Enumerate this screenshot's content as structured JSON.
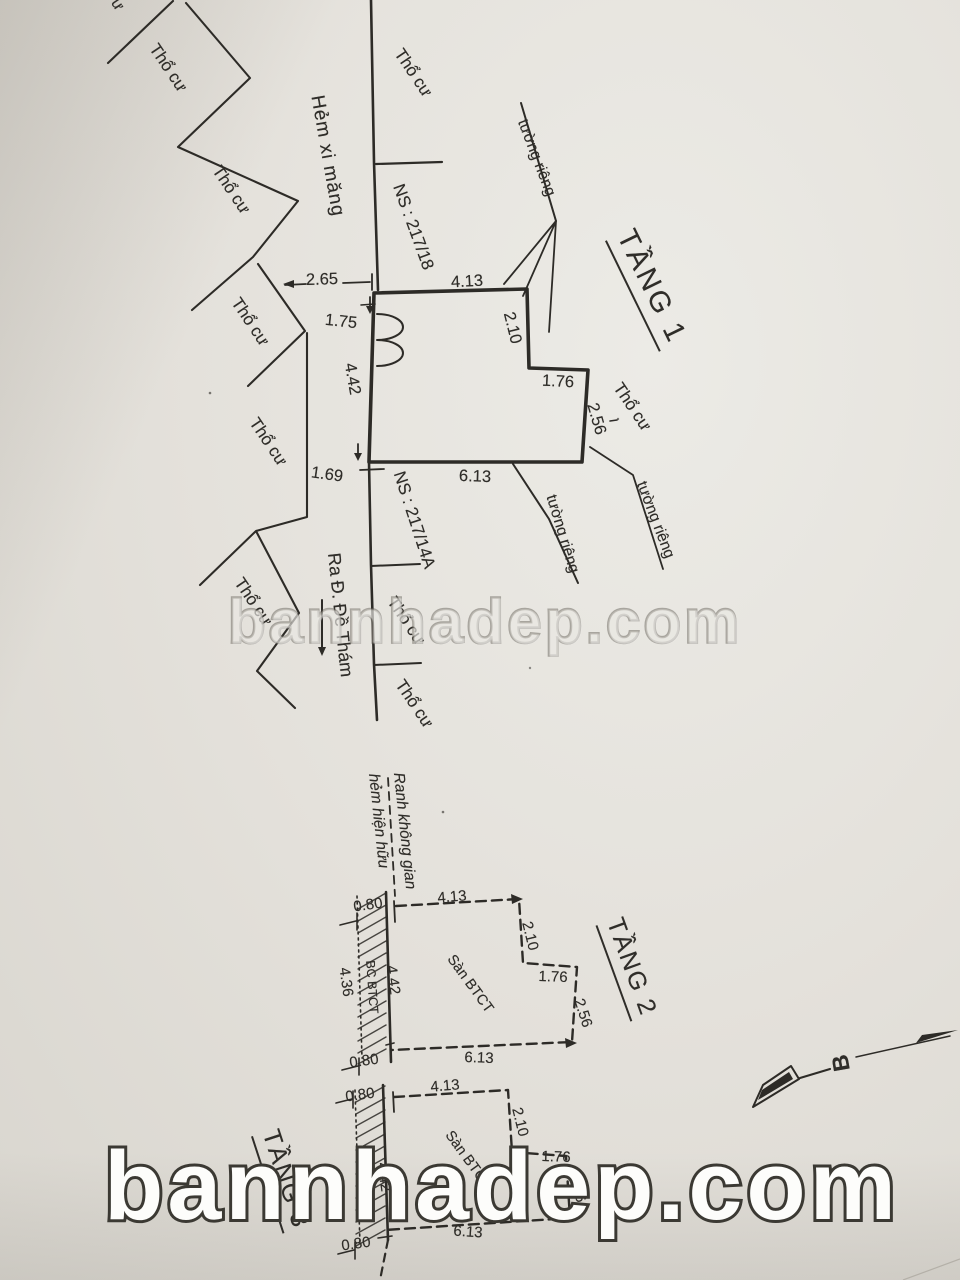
{
  "labels": {
    "tho_cu": "Thổ cư",
    "tho_cu_fragment": "ư",
    "tuong_rieng": "tường riêng",
    "hem_xi_mang": "Hẻm xi măng",
    "ns_217_18": "NS : 217/18",
    "ns_217_14a": "NS : 217/14A",
    "ra_de_tham": "Ra Đ. Đề Thám",
    "ranh_line1": "Ranh không gian",
    "ranh_line2": "hẻm hiện hữu"
  },
  "floors": {
    "f1": {
      "title": "TẦNG 1",
      "dims": {
        "offset_left": "2.65",
        "left_upper": "1.75",
        "left": "4.42",
        "offset_bottom": "1.69",
        "top": "4.13",
        "right_upper": "2.10",
        "step": "1.76",
        "right_lower": "2.56",
        "bottom": "6.13"
      }
    },
    "f2": {
      "title": "TẦNG 2",
      "slab": "Sàn BTCT",
      "balcony": "BC BTCT",
      "dims": {
        "offset_top": "0.80",
        "top": "4.13",
        "right_upper": "2.10",
        "step": "1.76",
        "right_lower": "2.56",
        "bottom": "6.13",
        "left": "4.42",
        "balcony_outer": "4.36",
        "offset_bottom": "0.80"
      }
    },
    "f3": {
      "title": "TẦNG 3",
      "slab": "Sàn BTCT",
      "dims": {
        "offset_top": "0.80",
        "top": "4.13",
        "right_upper": "2.10",
        "step": "1.76",
        "right_lower": "2.56",
        "bottom": "6.13",
        "left": "4.42",
        "offset_bottom": "0.80"
      }
    }
  },
  "compass": {
    "label": "B"
  },
  "watermarks": {
    "middle": "bannhadep.com",
    "bottom": "bannhadep.com"
  }
}
